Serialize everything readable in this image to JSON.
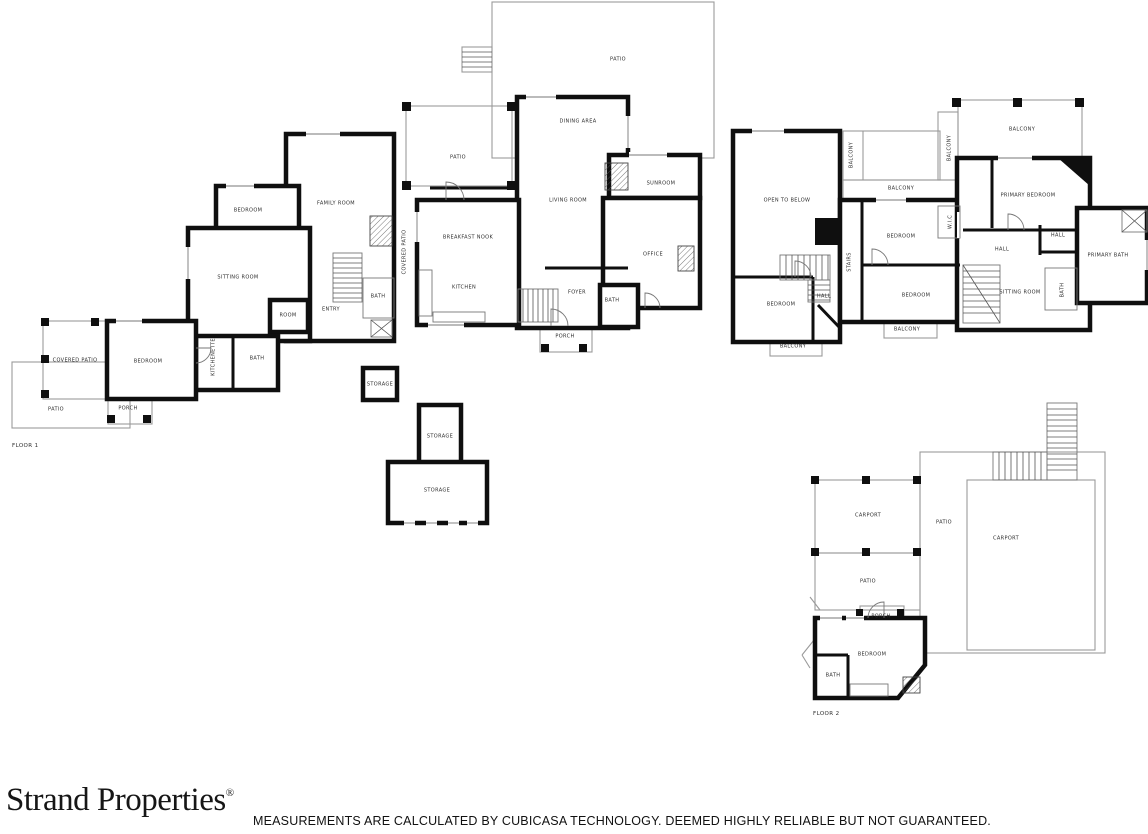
{
  "footer": {
    "brand": "Strand Properties",
    "registered": "®",
    "disclaimer": "MEASUREMENTS ARE CALCULATED BY CUBICASA TECHNOLOGY. DEEMED HIGHLY RELIABLE BUT NOT GUARANTEED."
  },
  "colors": {
    "wall": "#0f0f0f",
    "thin_line": "#9a9a9a",
    "label_text": "#2e2e2e",
    "background": "#ffffff"
  },
  "floor1": {
    "name": "FLOOR 1",
    "rooms": [
      {
        "label": "PATIO",
        "x": 618,
        "y": 60
      },
      {
        "label": "DINING AREA",
        "x": 578,
        "y": 122
      },
      {
        "label": "PATIO",
        "x": 458,
        "y": 158
      },
      {
        "label": "SUNROOM",
        "x": 661,
        "y": 184
      },
      {
        "label": "LIVING ROOM",
        "x": 568,
        "y": 201
      },
      {
        "label": "FAMILY ROOM",
        "x": 336,
        "y": 204
      },
      {
        "label": "BEDROOM",
        "x": 248,
        "y": 211
      },
      {
        "label": "BREAKFAST NOOK",
        "x": 468,
        "y": 238
      },
      {
        "label": "COVERED PATIO",
        "x": 405,
        "y": 252,
        "rot": true
      },
      {
        "label": "OFFICE",
        "x": 653,
        "y": 255
      },
      {
        "label": "SITTING ROOM",
        "x": 238,
        "y": 278
      },
      {
        "label": "KITCHEN",
        "x": 464,
        "y": 288
      },
      {
        "label": "FOYER",
        "x": 577,
        "y": 293
      },
      {
        "label": "ENTRY",
        "x": 331,
        "y": 310
      },
      {
        "label": "BATH",
        "x": 378,
        "y": 297
      },
      {
        "label": "ROOM",
        "x": 288,
        "y": 316
      },
      {
        "label": "BATH",
        "x": 612,
        "y": 301
      },
      {
        "label": "BEDROOM",
        "x": 148,
        "y": 362
      },
      {
        "label": "COVERED PATIO",
        "x": 75,
        "y": 361
      },
      {
        "label": "KITCHENETTE",
        "x": 214,
        "y": 357,
        "rot": true
      },
      {
        "label": "BATH",
        "x": 257,
        "y": 359
      },
      {
        "label": "PATIO",
        "x": 56,
        "y": 410
      },
      {
        "label": "PORCH",
        "x": 128,
        "y": 409
      },
      {
        "label": "PORCH",
        "x": 565,
        "y": 337
      },
      {
        "label": "STORAGE",
        "x": 380,
        "y": 385
      },
      {
        "label": "STORAGE",
        "x": 440,
        "y": 437
      },
      {
        "label": "STORAGE",
        "x": 437,
        "y": 491
      }
    ]
  },
  "floor2": {
    "name": "FLOOR 2",
    "rooms": [
      {
        "label": "BALCONY",
        "x": 1022,
        "y": 130
      },
      {
        "label": "BALCONY",
        "x": 950,
        "y": 148,
        "rot": true
      },
      {
        "label": "BALCONY",
        "x": 852,
        "y": 155,
        "rot": true
      },
      {
        "label": "BALCONY",
        "x": 901,
        "y": 189
      },
      {
        "label": "OPEN TO BELOW",
        "x": 787,
        "y": 201
      },
      {
        "label": "PRIMARY BEDROOM",
        "x": 1028,
        "y": 196
      },
      {
        "label": "BEDROOM",
        "x": 901,
        "y": 237
      },
      {
        "label": "W.I.C",
        "x": 951,
        "y": 222,
        "rot": true
      },
      {
        "label": "HALL",
        "x": 1058,
        "y": 236
      },
      {
        "label": "STAIRS",
        "x": 850,
        "y": 262,
        "rot": true
      },
      {
        "label": "HALL",
        "x": 1002,
        "y": 250
      },
      {
        "label": "PRIMARY BATH",
        "x": 1108,
        "y": 256
      },
      {
        "label": "BEDROOM",
        "x": 916,
        "y": 296
      },
      {
        "label": "HALL",
        "x": 824,
        "y": 297
      },
      {
        "label": "BEDROOM",
        "x": 781,
        "y": 305
      },
      {
        "label": "SITTING ROOM",
        "x": 1020,
        "y": 293
      },
      {
        "label": "BATH",
        "x": 1063,
        "y": 290,
        "rot": true
      },
      {
        "label": "BALCONY",
        "x": 907,
        "y": 330
      },
      {
        "label": "BALCONY",
        "x": 793,
        "y": 347
      },
      {
        "label": "CARPORT",
        "x": 868,
        "y": 516
      },
      {
        "label": "PATIO",
        "x": 944,
        "y": 523
      },
      {
        "label": "CARPORT",
        "x": 1006,
        "y": 539
      },
      {
        "label": "PATIO",
        "x": 868,
        "y": 582
      },
      {
        "label": "PORCH",
        "x": 881,
        "y": 617
      },
      {
        "label": "BEDROOM",
        "x": 872,
        "y": 655
      },
      {
        "label": "BATH",
        "x": 833,
        "y": 676
      }
    ]
  }
}
